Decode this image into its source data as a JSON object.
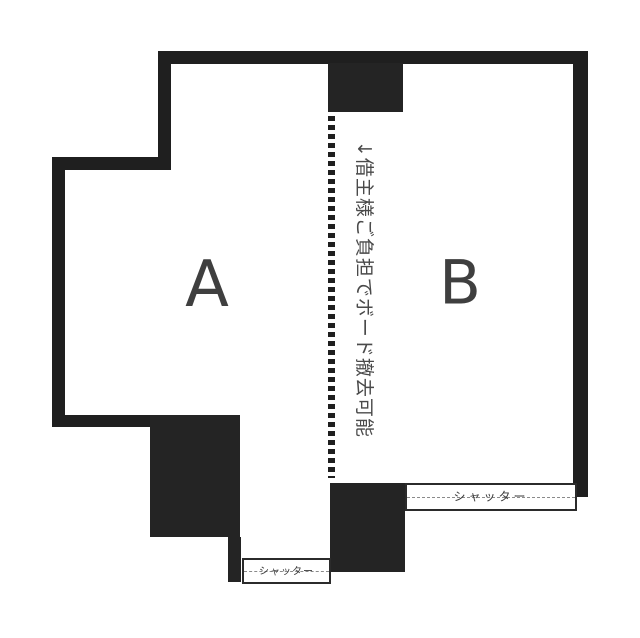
{
  "floorplan": {
    "title": "two-unit floor plan",
    "background_color": "#ffffff",
    "wall_color": "#1f1f1f",
    "unit_label_color": "#3f3f3f",
    "note_color": "#4a4a4a",
    "shutter_text_color": "#3a3a3a",
    "units": [
      {
        "id": "A",
        "label": "A"
      },
      {
        "id": "B",
        "label": "B"
      }
    ],
    "partition_note": "↓借主様ご負担でボード撤去可能",
    "shutters": {
      "bottom": {
        "label": "シャッター"
      },
      "right": {
        "label": "シャッター"
      }
    }
  }
}
